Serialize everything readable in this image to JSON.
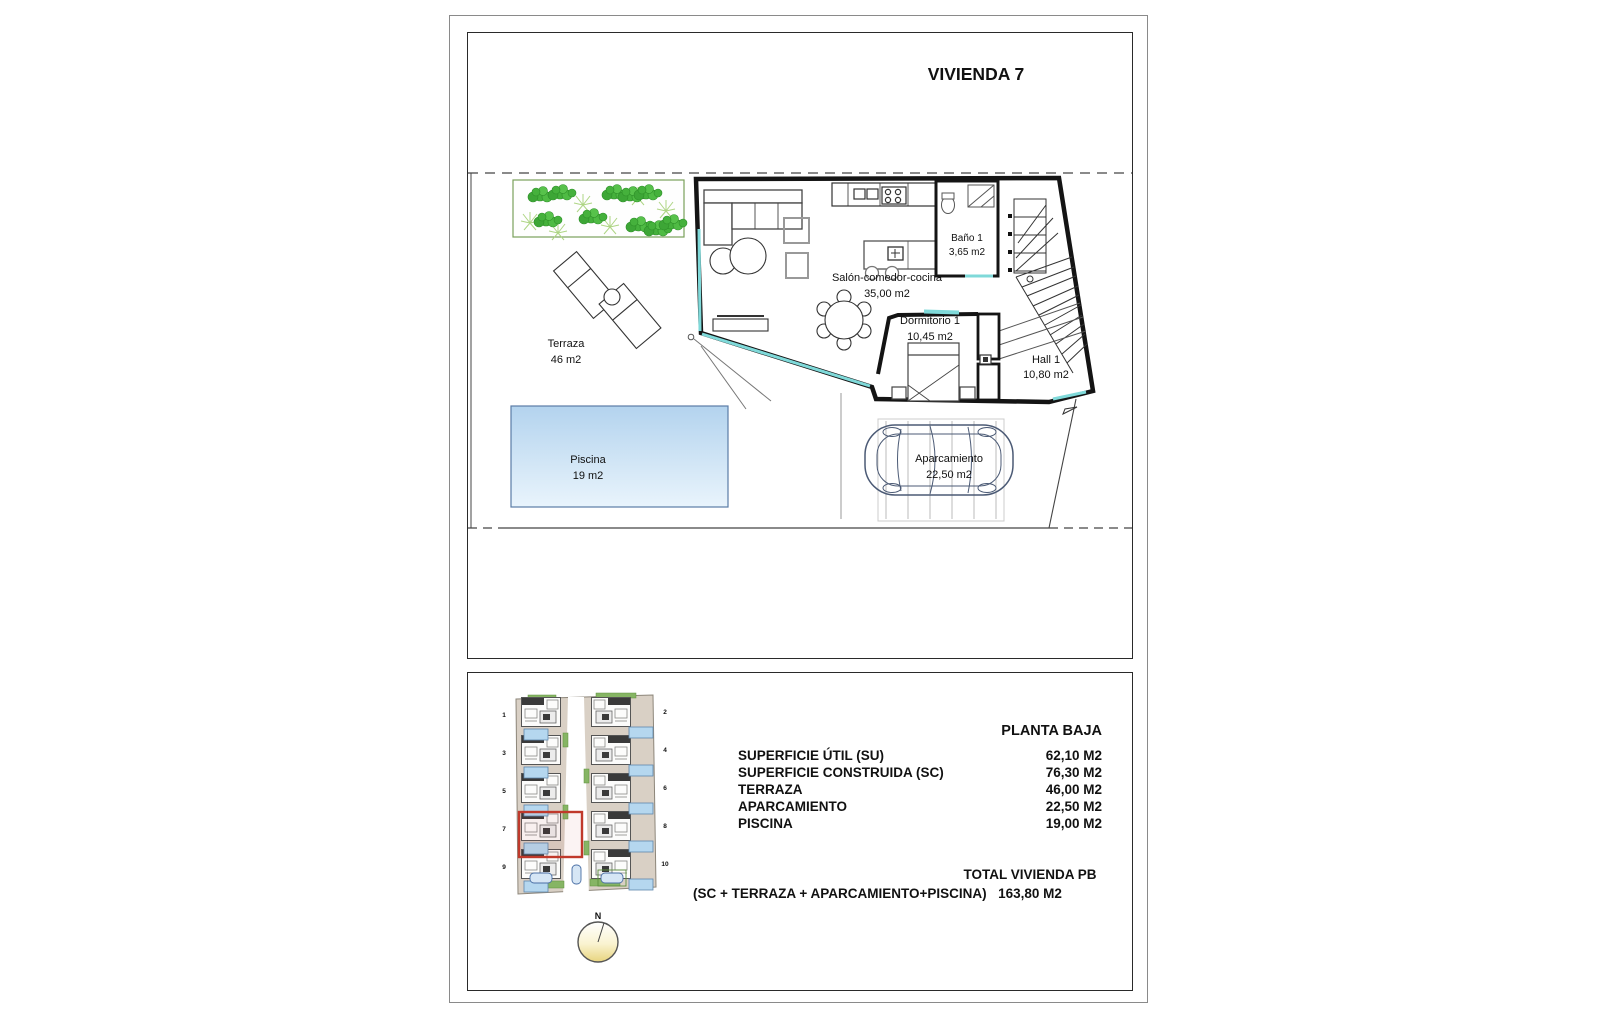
{
  "page": {
    "title": "VIVIENDA 7"
  },
  "plan": {
    "rooms": {
      "terraza": {
        "name": "Terraza",
        "area": "46 m2"
      },
      "piscina": {
        "name": "Piscina",
        "area": "19 m2"
      },
      "salon": {
        "name": "Salón-comedor-cocina",
        "area": "35,00 m2"
      },
      "bano": {
        "name": "Baño 1",
        "area": "3,65 m2"
      },
      "dormitorio": {
        "name": "Dormitorio 1",
        "area": "10,45 m2"
      },
      "hall": {
        "name": "Hall 1",
        "area": "10,80 m2"
      },
      "aparcamiento": {
        "name": "Aparcamiento",
        "area": "22,50 m2"
      }
    },
    "glazing_color": "#7fd9d9",
    "garden_green": "#45b13c",
    "pool_blue": "#b3d3ee"
  },
  "siteplan": {
    "numbers_left": [
      "1",
      "3",
      "5",
      "7",
      "9"
    ],
    "numbers_right": [
      "2",
      "4",
      "6",
      "8",
      "10"
    ],
    "compass": "N",
    "highlight_color": "#c0392b"
  },
  "summary": {
    "heading": "PLANTA BAJA",
    "rows": [
      {
        "label": "SUPERFICIE ÚTIL (SU)",
        "value": "62,10 M2"
      },
      {
        "label": "SUPERFICIE CONSTRUIDA (SC)",
        "value": "76,30 M2"
      },
      {
        "label": "TERRAZA",
        "value": "46,00 M2"
      },
      {
        "label": "APARCAMIENTO",
        "value": "22,50 M2"
      },
      {
        "label": "PISCINA",
        "value": "19,00 M2"
      }
    ],
    "formula": "(SC + TERRAZA + APARCAMIENTO+PISCINA)",
    "total_label": "TOTAL VIVIENDA PB",
    "total_value": "163,80 M2"
  }
}
